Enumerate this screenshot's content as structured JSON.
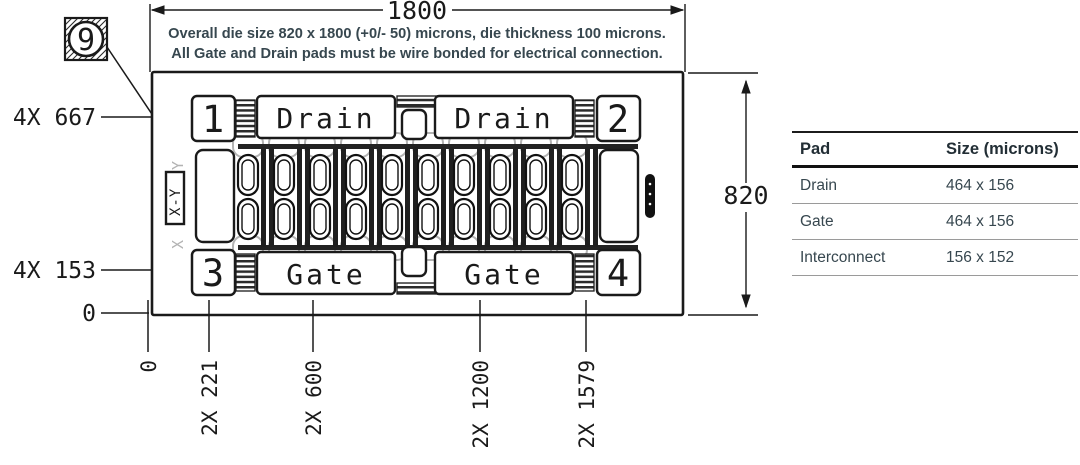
{
  "note": {
    "line1": "Overall die size 820 x 1800 (+0/- 50) microns, die thickness 100 microns.",
    "line2": "All Gate and Drain pads must be wire bonded for electrical connection."
  },
  "balloon": {
    "label": "9"
  },
  "dimensions": {
    "width_total": "1800",
    "height_total": "820",
    "left_callouts": [
      "4X 667",
      "4X 153",
      "0"
    ],
    "bottom_ticks": [
      "0",
      "2X 221",
      "2X 600",
      "2X 1200",
      "2X 1579"
    ]
  },
  "die": {
    "corner_pads": [
      "1",
      "2",
      "3",
      "4"
    ],
    "drain_pads": [
      "Drain",
      "Drain"
    ],
    "gate_pads": [
      "Gate",
      "Gate"
    ],
    "alignment_mark": "X-Y",
    "ghost_marks": [
      "Y",
      "X"
    ]
  },
  "pad_table": {
    "headers": [
      "Pad",
      "Size (microns)"
    ],
    "rows": [
      {
        "pad": "Drain",
        "size": "464 x 156"
      },
      {
        "pad": "Gate",
        "size": "464 x 156"
      },
      {
        "pad": "Interconnect",
        "size": "156 x 152"
      }
    ]
  },
  "colors": {
    "line": "#1a1a1a",
    "text": "#37474f",
    "gray": "#b3b3b3"
  }
}
